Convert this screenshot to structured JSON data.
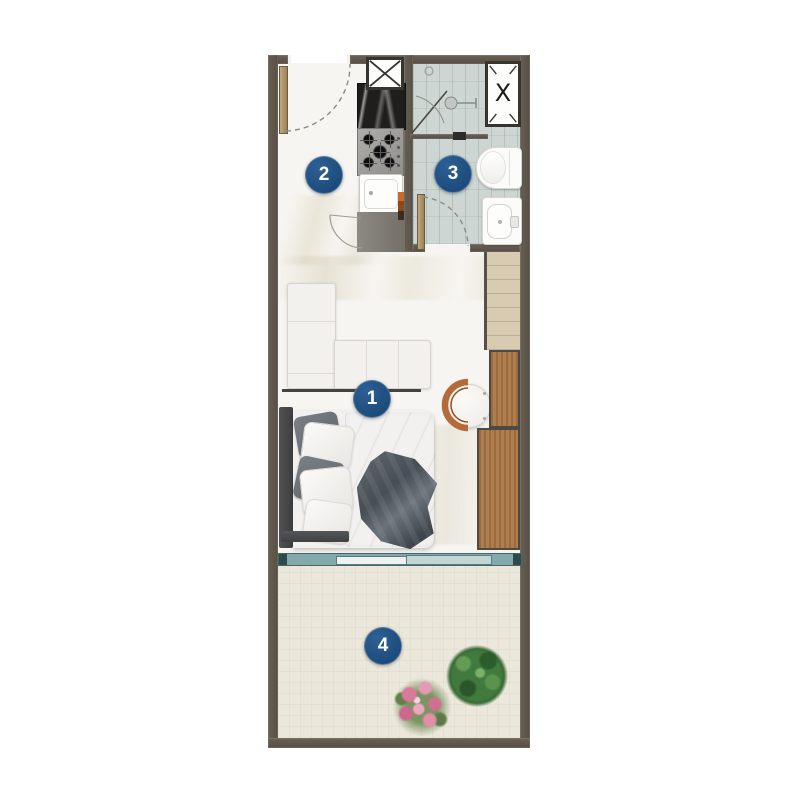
{
  "markers": [
    {
      "number": "1"
    },
    {
      "number": "2"
    },
    {
      "number": "3"
    },
    {
      "number": "4"
    }
  ],
  "shaft_right": {
    "glyph": "X"
  },
  "colors": {
    "wall": "#5c564c",
    "marker_blue": "#1d4c7c",
    "sliding_door_teal": "#84a9ac",
    "wardrobe_wood": "#b07e4c",
    "light_wood": "#d8cbb2",
    "bathroom_tile": "#cdd6d2",
    "marble_floor": "#f7f5f1",
    "balcony_floor": "#ece7db",
    "chair_terracotta": "#b46b39"
  }
}
